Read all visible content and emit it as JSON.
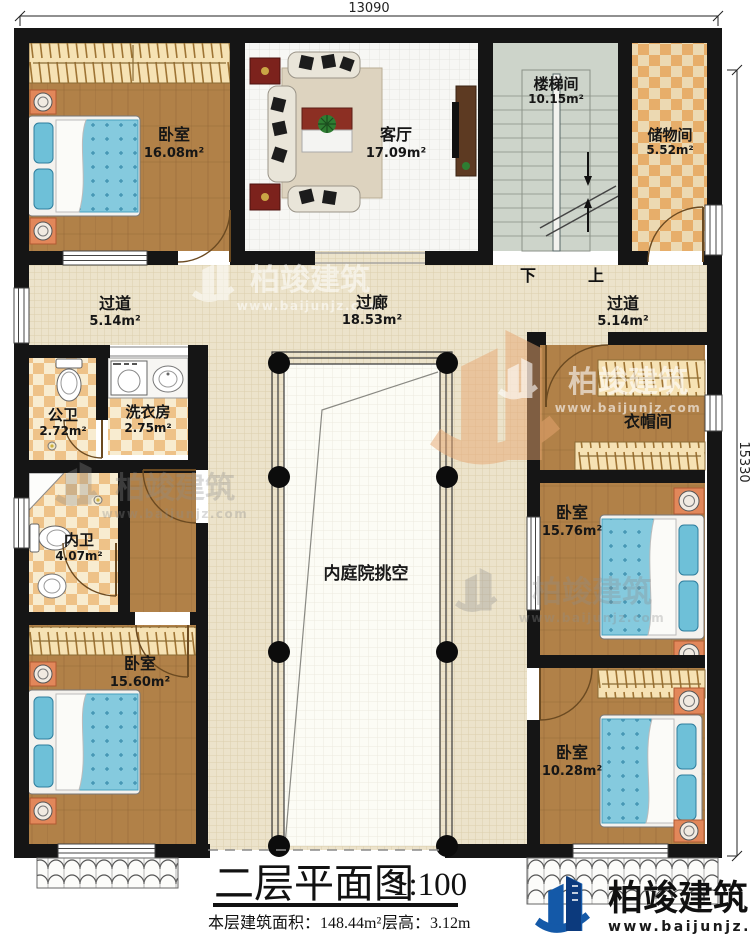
{
  "dimensions": {
    "top": "13090",
    "right": "15330"
  },
  "rooms": {
    "bedroom_top_left": {
      "label": "卧室",
      "area": "16.08m²"
    },
    "living_room": {
      "label": "客厅",
      "area": "17.09m²"
    },
    "stairwell": {
      "label": "楼梯间",
      "area": "10.15m²"
    },
    "storage": {
      "label": "储物间",
      "area": "5.52m²"
    },
    "corridor_left": {
      "label": "过道",
      "area": "5.14m²"
    },
    "gallery": {
      "label": "过廊",
      "area": "18.53m²"
    },
    "corridor_right": {
      "label": "过道",
      "area": "5.14m²"
    },
    "public_bath": {
      "label": "公卫",
      "area": "2.72m²"
    },
    "laundry": {
      "label": "洗衣房",
      "area": "2.75m²"
    },
    "private_bath": {
      "label": "内卫",
      "area": "4.07m²"
    },
    "bedroom_bottom_left": {
      "label": "卧室",
      "area": "15.60m²"
    },
    "cloakroom": {
      "label": "衣帽间",
      "area": ""
    },
    "bedroom_right_upper": {
      "label": "卧室",
      "area": "15.76m²"
    },
    "bedroom_right_lower": {
      "label": "卧室",
      "area": "10.28m²"
    },
    "courtyard": {
      "label": "内庭院挑空"
    }
  },
  "stairs": {
    "down": "下",
    "up": "上"
  },
  "title_block": {
    "title": "二层平面图",
    "scale": "1:100",
    "area_text": "本层建筑面积：148.44m²",
    "height_text": "层高：3.12m"
  },
  "brand": {
    "name": "柏竣建筑",
    "website": "www.baijunjz.com"
  },
  "watermark": {
    "name": "柏竣建筑",
    "website": "www.baijunjz.com"
  },
  "colors": {
    "wall": "#151515",
    "wood_floor": "#b18148",
    "corridor_tile": "#ece3cb",
    "checker_orange": "#eec288",
    "bed_teal": "#85cade",
    "brand_blue": "#1459a8"
  }
}
